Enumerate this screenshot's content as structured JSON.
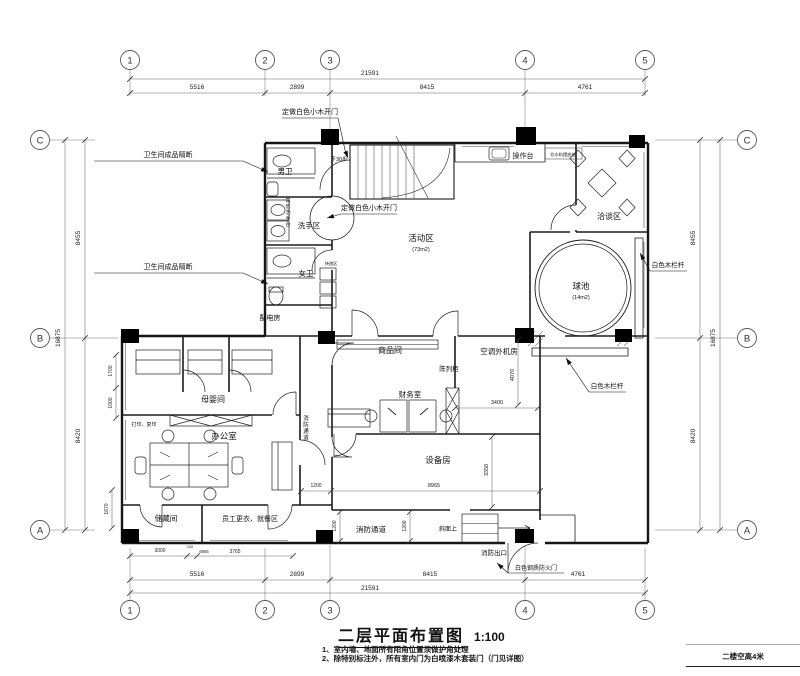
{
  "meta": {
    "title": "二层平面布置图",
    "scale": "1:100",
    "footer": "二楼空高4米",
    "notes": [
      "1、室内墙、地面所有阳角位置须做护角处理",
      "2、除特别标注外，所有室内门为白喷漆木套装门（门见详图）"
    ]
  },
  "grid": {
    "top": {
      "y": 60,
      "items": [
        {
          "n": "1",
          "x": 130
        },
        {
          "n": "2",
          "x": 265
        },
        {
          "n": "3",
          "x": 330
        },
        {
          "n": "4",
          "x": 525
        },
        {
          "n": "5",
          "x": 645
        }
      ]
    },
    "bottom": {
      "y": 610,
      "items": [
        {
          "n": "1",
          "x": 130
        },
        {
          "n": "2",
          "x": 265
        },
        {
          "n": "3",
          "x": 330
        },
        {
          "n": "4",
          "x": 525
        },
        {
          "n": "5",
          "x": 645
        }
      ]
    },
    "left": {
      "x": 40,
      "items": [
        {
          "n": "C",
          "y": 140
        },
        {
          "n": "B",
          "y": 338
        },
        {
          "n": "A",
          "y": 530
        }
      ]
    },
    "right": {
      "x": 747,
      "items": [
        {
          "n": "C",
          "y": 140
        },
        {
          "n": "B",
          "y": 338
        },
        {
          "n": "A",
          "y": 530
        }
      ]
    }
  },
  "dims": [
    {
      "o": "h",
      "pos": 79,
      "from": 130,
      "to": 645,
      "ticks": [
        130,
        645
      ],
      "texts": [
        {
          "t": "21591",
          "x": 370,
          "y": 75,
          "s": 6.5
        }
      ]
    },
    {
      "o": "h",
      "pos": 93,
      "from": 130,
      "to": 645,
      "ticks": [
        130,
        265,
        330,
        525,
        645
      ],
      "texts": [
        {
          "t": "5516",
          "x": 197,
          "y": 89,
          "s": 6.5
        },
        {
          "t": "2899",
          "x": 297,
          "y": 89,
          "s": 6.5
        },
        {
          "t": "8415",
          "x": 427,
          "y": 89,
          "s": 6.5
        },
        {
          "t": "4761",
          "x": 585,
          "y": 89,
          "s": 6.5
        }
      ]
    },
    {
      "o": "h",
      "pos": 580,
      "from": 130,
      "to": 645,
      "ticks": [
        130,
        265,
        330,
        525,
        645
      ],
      "texts": [
        {
          "t": "5516",
          "x": 197,
          "y": 576,
          "s": 6.5
        },
        {
          "t": "2899",
          "x": 297,
          "y": 576,
          "s": 6.5
        },
        {
          "t": "8415",
          "x": 430,
          "y": 576,
          "s": 6.5
        },
        {
          "t": "4761",
          "x": 578,
          "y": 576,
          "s": 6.5
        }
      ]
    },
    {
      "o": "h",
      "pos": 593,
      "from": 130,
      "to": 645,
      "ticks": [
        130,
        645
      ],
      "texts": [
        {
          "t": "21591",
          "x": 370,
          "y": 590,
          "s": 6.5
        }
      ]
    },
    {
      "o": "v",
      "pos": 65,
      "from": 140,
      "to": 530,
      "ticks": [
        140,
        530
      ],
      "texts": [
        {
          "t": "16875",
          "x": 60,
          "y": 338,
          "r": -90,
          "s": 6.5
        }
      ]
    },
    {
      "o": "v",
      "pos": 85,
      "from": 140,
      "to": 530,
      "ticks": [
        140,
        338,
        530
      ],
      "texts": [
        {
          "t": "8455",
          "x": 80,
          "y": 238,
          "r": -90,
          "s": 6.5
        },
        {
          "t": "8420",
          "x": 80,
          "y": 436,
          "r": -90,
          "s": 6.5
        }
      ]
    },
    {
      "o": "v",
      "pos": 700,
      "from": 140,
      "to": 530,
      "ticks": [
        140,
        338,
        530
      ],
      "texts": [
        {
          "t": "8455",
          "x": 695,
          "y": 238,
          "r": -90,
          "s": 6.5
        },
        {
          "t": "8420",
          "x": 695,
          "y": 436,
          "r": -90,
          "s": 6.5
        }
      ]
    },
    {
      "o": "v",
      "pos": 720,
      "from": 140,
      "to": 530,
      "ticks": [
        140,
        530
      ],
      "texts": [
        {
          "t": "16875",
          "x": 715,
          "y": 338,
          "r": -90,
          "s": 6.5
        }
      ]
    },
    {
      "o": "v",
      "pos": 116,
      "from": 355,
      "to": 418,
      "ticks": [
        355,
        388,
        418
      ],
      "texts": [
        {
          "t": "1700",
          "x": 112,
          "y": 371,
          "r": -90,
          "s": 5
        },
        {
          "t": "1000",
          "x": 112,
          "y": 403,
          "r": -90,
          "s": 5
        }
      ]
    },
    {
      "o": "v",
      "pos": 112,
      "from": 490,
      "to": 528,
      "ticks": [
        490,
        528
      ],
      "texts": [
        {
          "t": "1670",
          "x": 108,
          "y": 509,
          "r": -90,
          "s": 5
        }
      ]
    },
    {
      "o": "h",
      "pos": 556,
      "from": 130,
      "to": 293,
      "ticks": [
        130,
        187,
        197,
        293
      ],
      "texts": [
        {
          "t": "3000",
          "x": 160,
          "y": 552,
          "s": 5
        },
        {
          "t": "100",
          "x": 190,
          "y": 548,
          "s": 3.8
        },
        {
          "t": "6865",
          "x": 204,
          "y": 553,
          "s": 4.2
        },
        {
          "t": "3765",
          "x": 235,
          "y": 553,
          "s": 5
        }
      ]
    },
    {
      "o": "h",
      "pos": 491,
      "from": 301,
      "to": 540,
      "ticks": [
        301,
        331,
        540
      ],
      "texts": [
        {
          "t": "1200",
          "x": 316,
          "y": 487,
          "s": 5
        },
        {
          "t": "8965",
          "x": 434,
          "y": 487,
          "s": 5.5
        }
      ]
    },
    {
      "o": "v",
      "pos": 340,
      "from": 512,
      "to": 541,
      "ticks": [
        512,
        541
      ],
      "texts": [
        {
          "t": "1200",
          "x": 336,
          "y": 526,
          "r": -90,
          "s": 5
        }
      ]
    },
    {
      "o": "v",
      "pos": 410,
      "from": 512,
      "to": 541,
      "ticks": [
        512,
        541
      ],
      "texts": [
        {
          "t": "1200",
          "x": 406,
          "y": 526,
          "r": -90,
          "s": 5
        }
      ]
    },
    {
      "o": "v",
      "pos": 492,
      "from": 437,
      "to": 507,
      "ticks": [
        437,
        507
      ],
      "texts": [
        {
          "t": "3350",
          "x": 488,
          "y": 470,
          "r": -90,
          "s": 5.5
        }
      ]
    },
    {
      "o": "h",
      "pos": 408,
      "from": 455,
      "to": 538,
      "ticks": [
        455,
        538
      ],
      "texts": [
        {
          "t": "3400",
          "x": 497,
          "y": 404,
          "s": 5.5
        }
      ]
    },
    {
      "o": "v",
      "pos": 518,
      "from": 340,
      "to": 405,
      "ticks": [
        340,
        405
      ],
      "texts": [
        {
          "t": "4070",
          "x": 514,
          "y": 375,
          "r": -90,
          "s": 5.5
        }
      ]
    }
  ],
  "rooms": [
    {
      "t": "男卫",
      "x": 285,
      "y": 174,
      "s": 7.5
    },
    {
      "t": "洗手区",
      "x": 309,
      "y": 228,
      "s": 7.5
    },
    {
      "t": "女卫",
      "x": 306,
      "y": 276,
      "s": 7.5
    },
    {
      "t": "配电房",
      "x": 270,
      "y": 320,
      "s": 7
    },
    {
      "t": "活动区",
      "x": 421,
      "y": 241,
      "s": 8.5
    },
    {
      "t": "(73m2)",
      "x": 421,
      "y": 251,
      "s": 5.5
    },
    {
      "t": "球池",
      "x": 581,
      "y": 289,
      "s": 8.5
    },
    {
      "t": "(14m2)",
      "x": 581,
      "y": 299,
      "s": 5.5
    },
    {
      "t": "洽谈区",
      "x": 609,
      "y": 219,
      "s": 8
    },
    {
      "t": "操作台",
      "x": 523,
      "y": 158,
      "s": 7
    },
    {
      "t": "母婴间",
      "x": 213,
      "y": 402,
      "s": 8
    },
    {
      "t": "办公室",
      "x": 224,
      "y": 439,
      "s": 8.5
    },
    {
      "t": "商品间",
      "x": 390,
      "y": 353,
      "s": 8
    },
    {
      "t": "陈列柜",
      "x": 449,
      "y": 371,
      "s": 6.5
    },
    {
      "t": "财务室",
      "x": 410,
      "y": 397,
      "s": 7.5
    },
    {
      "t": "空调外机房",
      "x": 499,
      "y": 354,
      "s": 7.5
    },
    {
      "t": "设备房",
      "x": 438,
      "y": 463,
      "s": 8.5
    },
    {
      "t": "储藏间",
      "x": 166,
      "y": 521,
      "s": 7.5
    },
    {
      "t": "员工更衣、就餐区",
      "x": 250,
      "y": 521,
      "s": 7
    },
    {
      "t": "消防通道",
      "x": 371,
      "y": 532,
      "s": 7.5
    },
    {
      "t": "消防出口",
      "x": 494,
      "y": 555,
      "s": 6.5
    },
    {
      "t": "斜面上",
      "x": 448,
      "y": 531,
      "s": 6
    },
    {
      "t": "下30步",
      "x": 339,
      "y": 161,
      "s": 5.5
    },
    {
      "t": "打印、复印",
      "x": 144,
      "y": 426,
      "s": 5
    },
    {
      "t": "快递区",
      "x": 331,
      "y": 265,
      "s": 4.2
    },
    {
      "t": "饮水机摆放处",
      "x": 563,
      "y": 156,
      "s": 4.2
    }
  ],
  "vertical_labels": [
    {
      "t": "高低洗手台",
      "x": 288,
      "y": 202,
      "s": 5,
      "dy": 6
    },
    {
      "t": "消防通道",
      "x": 306,
      "y": 420,
      "s": 5.5,
      "dy": 6.5
    }
  ],
  "leaders": [
    {
      "t": "定做白色小木开门",
      "x": 310,
      "y": 114,
      "s": 7,
      "ul": [
        282,
        118,
        338,
        118
      ],
      "pts": [
        [
          338,
          118
        ],
        [
          345,
          150
        ],
        [
          348,
          158
        ]
      ],
      "arrow": true
    },
    {
      "t": "定做白色小木开门",
      "x": 369,
      "y": 210,
      "s": 7,
      "ul": [
        341,
        214,
        397,
        214
      ],
      "pts": [
        [
          341,
          214
        ],
        [
          327,
          218
        ]
      ],
      "arrow": true
    },
    {
      "t": "卫生间成品隔断",
      "x": 168,
      "y": 157,
      "s": 7,
      "ul": [
        94,
        161,
        243,
        161
      ],
      "pts": [
        [
          243,
          161
        ],
        [
          268,
          172
        ]
      ],
      "arrow": true
    },
    {
      "t": "卫生间成品隔断",
      "x": 168,
      "y": 269,
      "s": 7,
      "ul": [
        94,
        273,
        243,
        273
      ],
      "pts": [
        [
          243,
          273
        ],
        [
          268,
          284
        ]
      ],
      "arrow": true
    },
    {
      "t": "白色木栏杆",
      "x": 668,
      "y": 267,
      "s": 6.5,
      "ul": [
        650,
        271,
        687,
        271
      ],
      "pts": [
        [
          650,
          271
        ],
        [
          640,
          253
        ]
      ],
      "arrow": true
    },
    {
      "t": "白色木栏杆",
      "x": 607,
      "y": 388,
      "s": 6.5,
      "ul": [
        589,
        392,
        626,
        392
      ],
      "pts": [
        [
          589,
          392
        ],
        [
          566,
          358
        ]
      ],
      "arrow": true
    },
    {
      "t": "白色钢质防火门",
      "x": 536,
      "y": 570,
      "s": 6,
      "ul": [
        508,
        573,
        564,
        573
      ],
      "pts": [
        [
          508,
          573
        ],
        [
          497,
          563
        ]
      ],
      "arrow": true
    }
  ],
  "columns": [
    [
      321,
      129,
      18,
      16
    ],
    [
      516,
      127,
      20,
      18
    ],
    [
      629,
      135,
      16,
      13
    ],
    [
      121,
      329,
      18,
      14
    ],
    [
      318,
      331,
      17,
      13
    ],
    [
      515,
      328,
      19,
      15
    ],
    [
      615,
      329,
      17,
      13
    ],
    [
      121,
      529,
      18,
      14
    ],
    [
      316,
      530,
      17,
      13
    ],
    [
      515,
      529,
      19,
      14
    ]
  ]
}
